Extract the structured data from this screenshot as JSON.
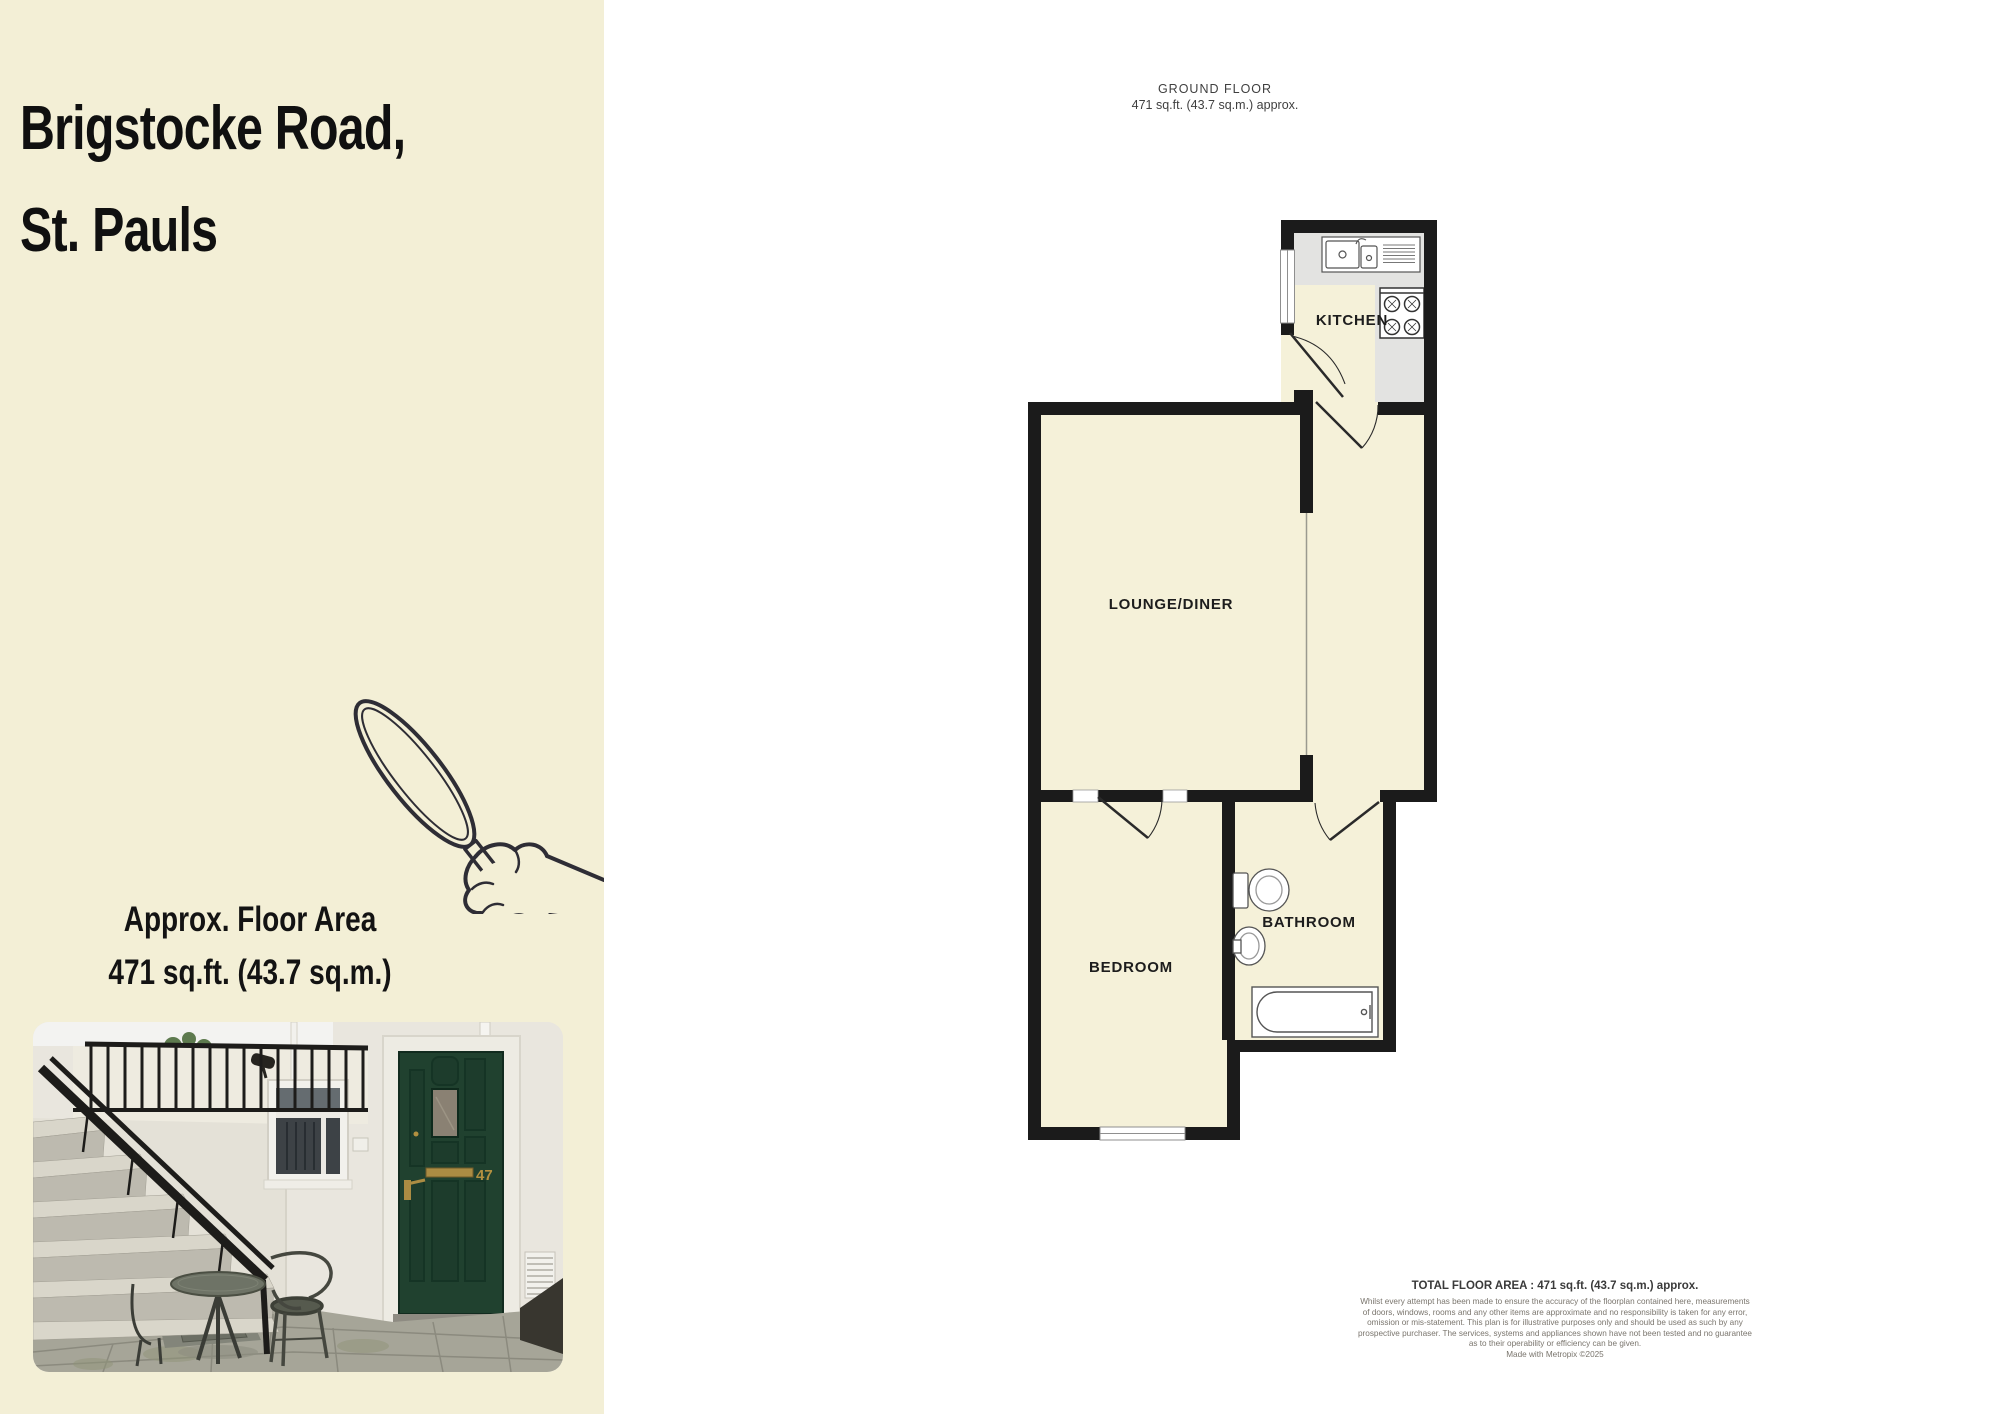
{
  "sidebar": {
    "bg_color": "#f3efd6",
    "title_line1": "Brigstocke Road,",
    "title_line2": "St. Pauls",
    "area_label": "Approx. Floor Area",
    "area_value": "471 sq.ft. (43.7 sq.m.)"
  },
  "plan": {
    "header_title": "GROUND FLOOR",
    "header_subtitle": "471 sq.ft. (43.7 sq.m.) approx.",
    "rooms": [
      {
        "label": "KITCHEN"
      },
      {
        "label": "LOUNGE/DINER"
      },
      {
        "label": "BEDROOM"
      },
      {
        "label": "BATHROOM"
      }
    ],
    "colors": {
      "wall": "#1b1b1b",
      "floor": "#f5f1d9",
      "counter": "#e3e3e1"
    }
  },
  "footer": {
    "total_area": "TOTAL FLOOR AREA : 471 sq.ft. (43.7 sq.m.) approx.",
    "disclaimer_lines": [
      "Whilst every attempt has been made to ensure the accuracy of the floorplan contained here, measurements",
      "of doors, windows, rooms and any other items are approximate and no responsibility is taken for any error,",
      "omission or mis-statement. This plan is for illustrative purposes only and should be used as such by any",
      "prospective purchaser. The services, systems and appliances shown have not been tested and no guarantee",
      "as to their operability or efficiency can be given."
    ],
    "credit": "Made with Metropix ©2025"
  },
  "photo": {
    "door_number": "47",
    "door_color": "#20412f"
  }
}
